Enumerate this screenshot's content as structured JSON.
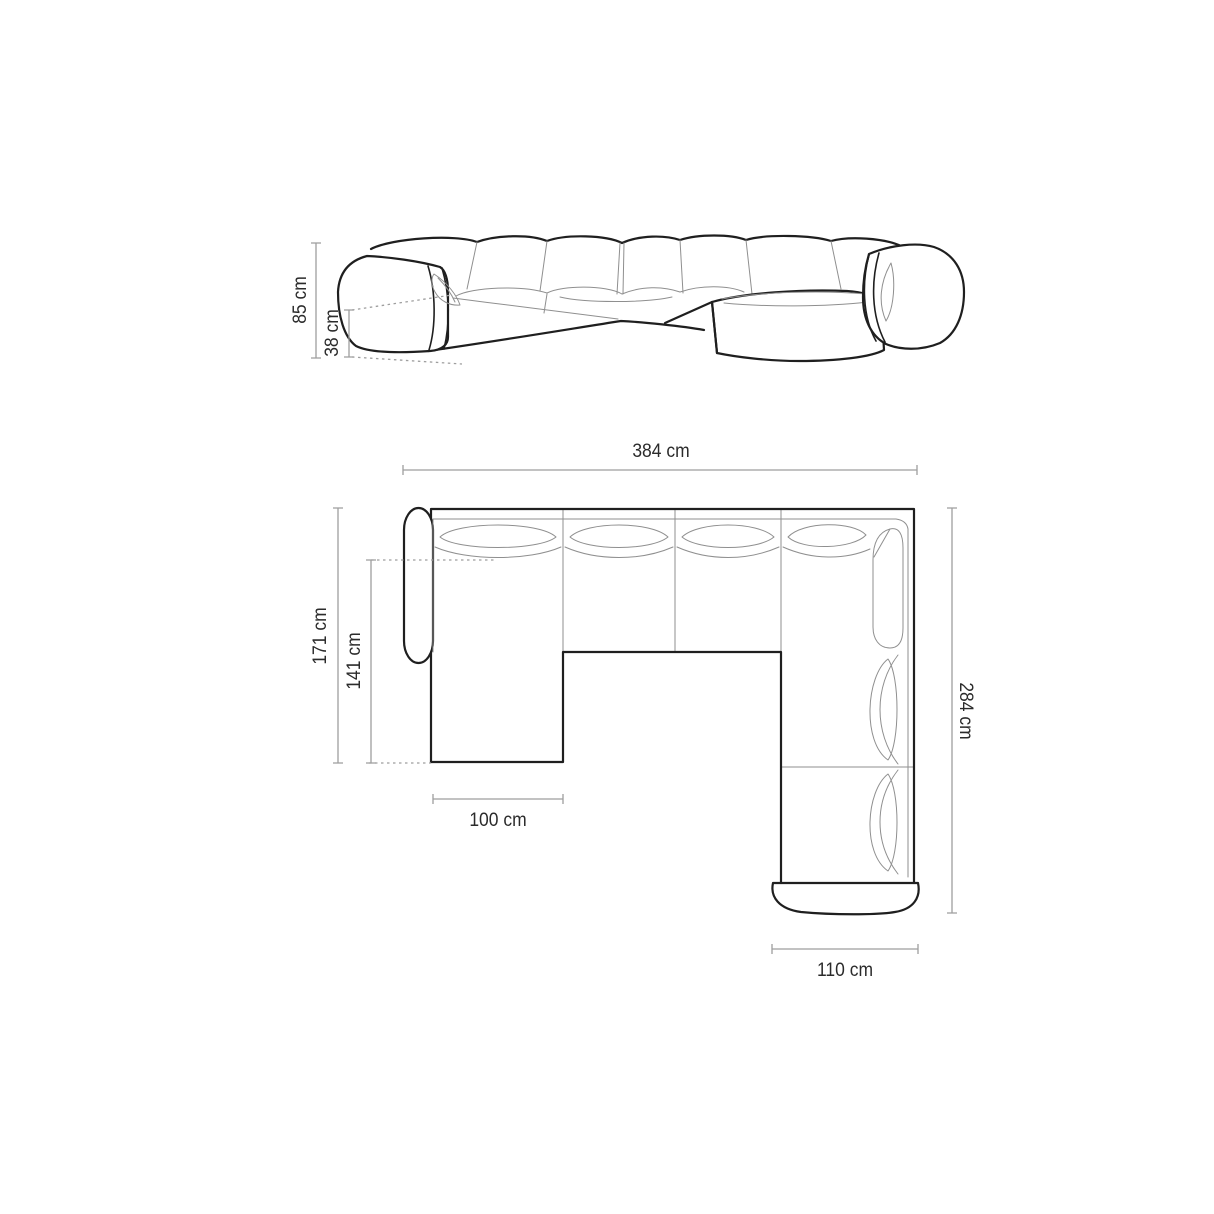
{
  "diagram": {
    "subject": "panoramic-corner-sofa-dimension-diagram",
    "unit": "cm",
    "colors": {
      "background": "#ffffff",
      "outline": "#1f1f1f",
      "detail_line": "#8f8f8f",
      "dimension_line": "#9e9e9e",
      "label_text": "#2b2b2b"
    },
    "elevation": {
      "view_name": "front-elevation-view",
      "dims": {
        "total_height": {
          "label": "85 cm",
          "value": 85
        },
        "seat_height": {
          "label": "38 cm",
          "value": 38
        }
      }
    },
    "plan": {
      "view_name": "top-plan-view",
      "dims": {
        "total_width": {
          "label": "384 cm",
          "value": 384
        },
        "left_depth": {
          "label": "171 cm",
          "value": 171
        },
        "left_chaise_length": {
          "label": "141 cm",
          "value": 141
        },
        "right_depth": {
          "label": "284 cm",
          "value": 284
        },
        "left_chaise_width": {
          "label": "100 cm",
          "value": 100
        },
        "right_chaise_width": {
          "label": "110 cm",
          "value": 110
        }
      }
    }
  }
}
